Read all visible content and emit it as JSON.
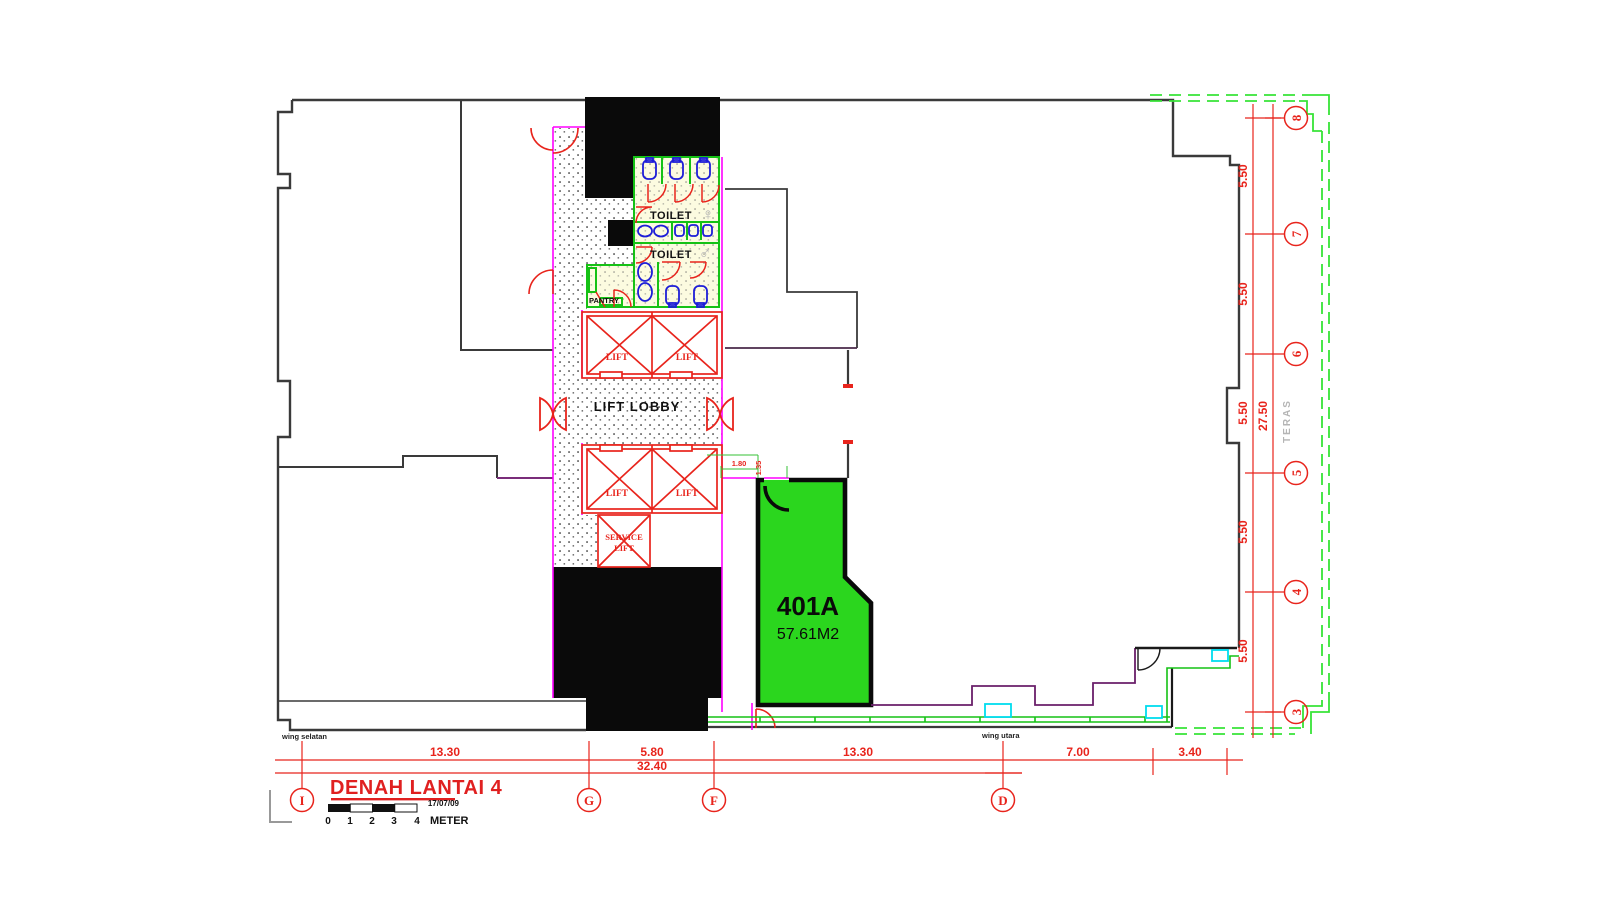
{
  "plan": {
    "title": "DENAH LANTAI 4",
    "date": "17/07/09",
    "meter_label": "METER",
    "scale_ticks": [
      "0",
      "1",
      "2",
      "3",
      "4"
    ],
    "wing_south_label": "wing selatan",
    "wing_north_label": "wing utara",
    "terrace_label": "TERAS"
  },
  "core": {
    "lift_lobby_label": "LIFT LOBBY",
    "toilet_female_label": "TOILET",
    "toilet_male_label": "TOILET",
    "pantry_label": "PANTRY",
    "lift_labels": [
      "LIFT",
      "LIFT",
      "LIFT",
      "LIFT"
    ],
    "service_lift_line1": "SERVICE",
    "service_lift_line2": "LIFT",
    "female_symbol": "♀",
    "male_symbol": "♂"
  },
  "unit": {
    "id": "401A",
    "area": "57.61M2"
  },
  "grid": {
    "bottom": [
      "I",
      "G",
      "F",
      "D"
    ],
    "right": [
      "8",
      "7",
      "6",
      "5",
      "4",
      "3"
    ]
  },
  "dims": {
    "bottom": [
      "13.30",
      "5.80",
      "13.30",
      "7.00",
      "3.40"
    ],
    "bottom_total": "32.40",
    "right": [
      "5.50",
      "5.50",
      "5.50",
      "5.50",
      "5.50"
    ],
    "right_total": "27.50",
    "entry_width": "1.80",
    "entry_depth": "1.35"
  },
  "colors": {
    "unit_fill": "#2bd61e",
    "wall": "#3a3a3a",
    "cad_red": "#e8241c",
    "magenta": "#ff00ff",
    "green": "#15c215",
    "terrace_green": "#37e437",
    "cyan": "#00dcee",
    "toilet_fill": "#fcfbe0",
    "fixture_blue": "#1d1dd8"
  }
}
